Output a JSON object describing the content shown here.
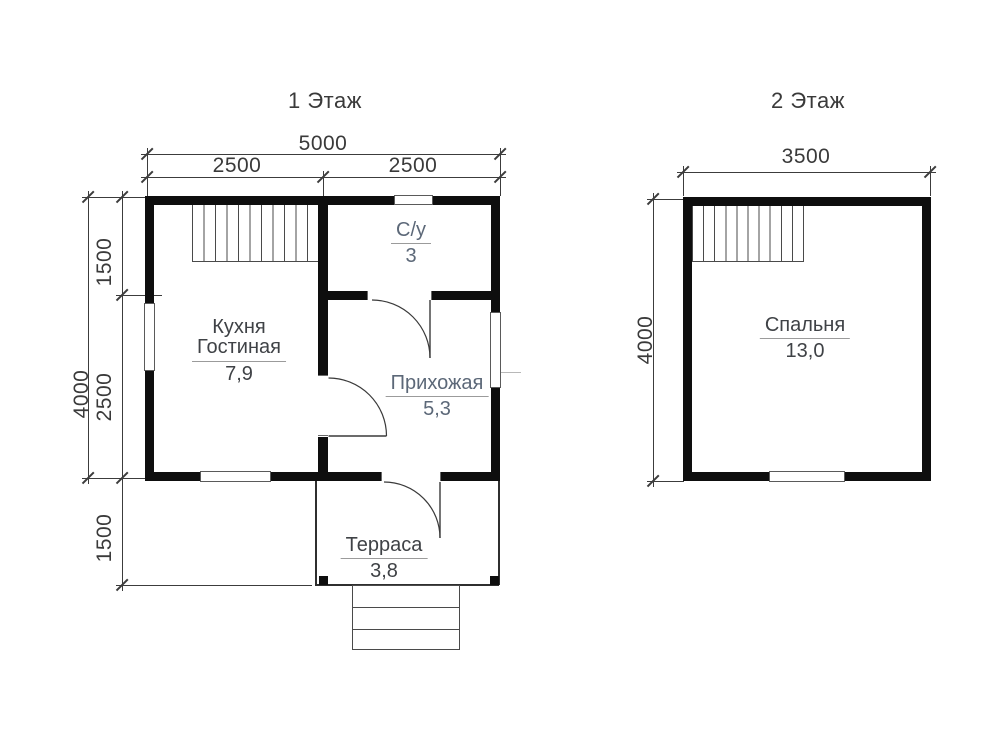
{
  "colors": {
    "wall": "#0e0e0e",
    "line": "#3c3c3c",
    "dim-text": "#3a3a3a",
    "label-dark": "#3f4246",
    "label-blue": "#5c6878",
    "underline": "#9b9b9b"
  },
  "floor1": {
    "title": "1 Этаж",
    "dims": {
      "total_width": "5000",
      "left_width": "2500",
      "right_width": "2500",
      "total_height": "4000",
      "top_height": "1500",
      "bottom_height": "2500",
      "terrace_depth": "1500"
    },
    "rooms": {
      "kitchen": {
        "name_line1": "Кухня",
        "name_line2": "Гостиная",
        "area": "7,9"
      },
      "bathroom": {
        "name": "С/у",
        "area": "3"
      },
      "hallway": {
        "name": "Прихожая",
        "area": "5,3"
      },
      "terrace": {
        "name": "Терраса",
        "area": "3,8"
      }
    }
  },
  "floor2": {
    "title": "2 Этаж",
    "dims": {
      "width": "3500",
      "height": "4000"
    },
    "rooms": {
      "bedroom": {
        "name": "Спальня",
        "area": "13,0"
      }
    }
  }
}
